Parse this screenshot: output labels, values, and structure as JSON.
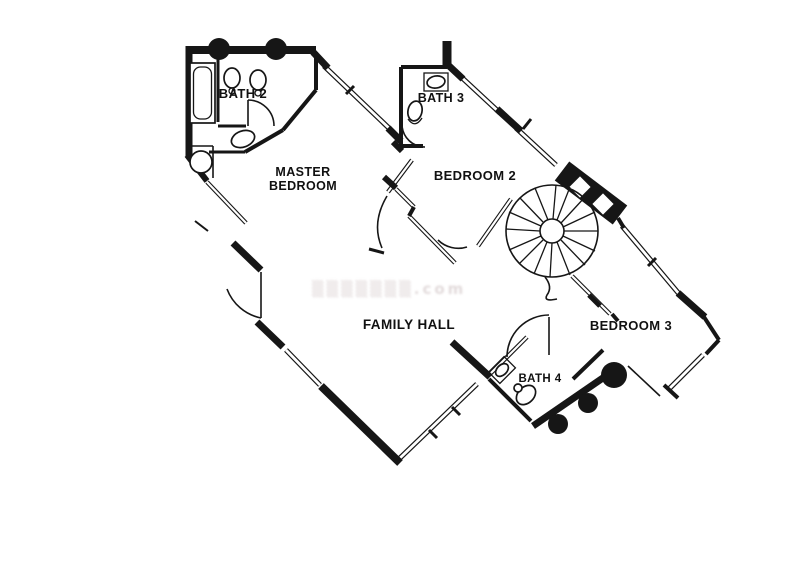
{
  "page": {
    "background": "#ffffff"
  },
  "colors": {
    "wall": "#161616",
    "label": "#111111",
    "watermark": "#cfc2c3"
  },
  "rooms": {
    "bath2": {
      "label": "BATH 2"
    },
    "bath3": {
      "label": "BATH 3"
    },
    "bath4": {
      "label": "BATH 4"
    },
    "master": {
      "line1": "MASTER",
      "line2": "BEDROOM"
    },
    "bedroom2": {
      "label": "BEDROOM 2"
    },
    "bedroom3": {
      "label": "BEDROOM 3"
    },
    "family_hall": {
      "label": "FAMILY HALL"
    }
  },
  "fixtures": [
    "bathtub-icon",
    "sink-icon",
    "toilet-icon",
    "shower-icon",
    "spiral-staircase-icon",
    "door-swing-icon",
    "window-wall",
    "column-icon",
    "chimney-icon"
  ],
  "watermark": {
    "text": "▒▒▒▒▒▒▒.com"
  }
}
